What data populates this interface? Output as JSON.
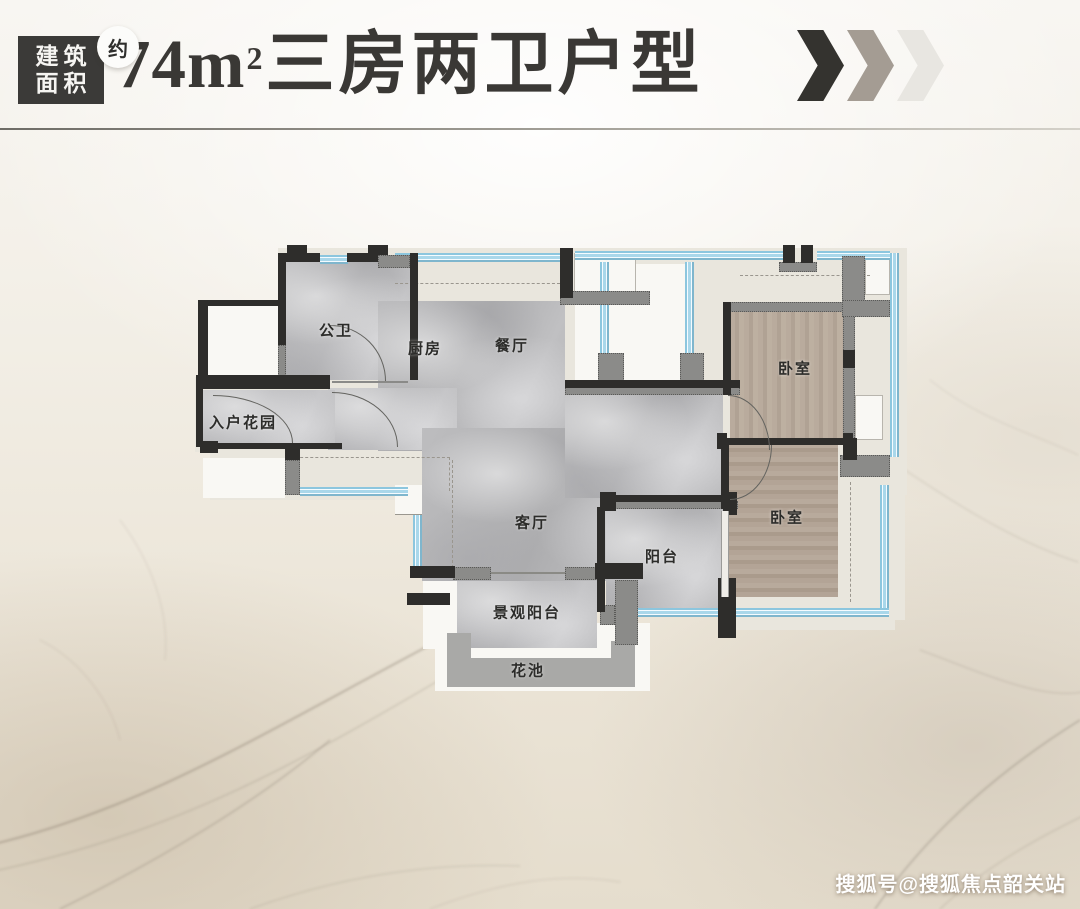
{
  "header": {
    "badge": {
      "line1": "建筑",
      "line2": "面积",
      "tag": "约"
    },
    "title": {
      "prefix": "74m",
      "sup": "2",
      "suffix": "三房两卫户型"
    },
    "chevrons": {
      "colors": [
        "#34332f",
        "#a49c93",
        "#e8e6e1"
      ]
    }
  },
  "floorplan": {
    "rooms": [
      {
        "id": "bathroom",
        "label": "公卫"
      },
      {
        "id": "kitchen",
        "label": "厨房"
      },
      {
        "id": "dining",
        "label": "餐厅"
      },
      {
        "id": "entry-garden",
        "label": "入户花园"
      },
      {
        "id": "living",
        "label": "客厅"
      },
      {
        "id": "balcony",
        "label": "阳台"
      },
      {
        "id": "bedroom-upper",
        "label": "卧室"
      },
      {
        "id": "bedroom-lower",
        "label": "卧室"
      },
      {
        "id": "scenic-balcony",
        "label": "景观阳台"
      },
      {
        "id": "flower-bed",
        "label": "花池"
      }
    ]
  },
  "watermark": "搜狐号@搜狐焦点韶关站",
  "theme": {
    "wall_dark": "#2e2d2b",
    "wall_gray": "#8b8b89",
    "window_blue": "#8cc6de",
    "floor_marble": "#b2b2b4",
    "floor_wood": "#b5a89a",
    "band_beige": "#e9e6dd",
    "title_color": "#3a3835",
    "divider_left": "#6e6c66",
    "divider_right": "#d4d1c9"
  }
}
